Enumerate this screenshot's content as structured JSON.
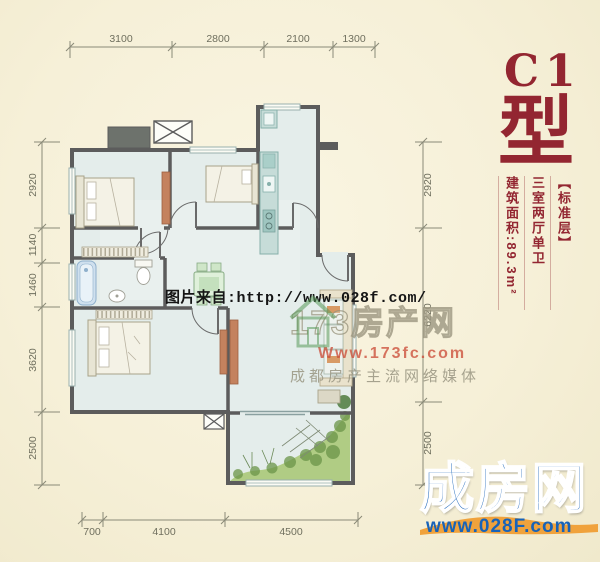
{
  "title_block": {
    "model": "C1",
    "type_suffix": "型",
    "floor_tag": "【标准层】",
    "layout_desc": "三室两厅单卫",
    "area_label": "建筑面积:89.3m²"
  },
  "watermarks": {
    "photo_source": "图片来自:http://www.028f.com/",
    "portal_name": "173房产网",
    "portal_url": "Www.173fc.com",
    "portal_slogan": "成都房产主流网络媒体"
  },
  "footer_logo": {
    "name": "成房网",
    "url": "www.028F.com"
  },
  "dims": {
    "top": [
      "3100",
      "2800",
      "2100",
      "1300"
    ],
    "left": [
      "2920",
      "1140",
      "1460",
      "3620",
      "2500"
    ],
    "right": [
      "2920",
      "6220",
      "2500"
    ],
    "bottom": [
      "700",
      "4100",
      "4500"
    ]
  },
  "colors": {
    "accent_red": "#932631",
    "logo_blue": "#1863b8",
    "logo_orange": "#f0a23c",
    "floor_fill": "#e4edeb",
    "wall_gray": "#5c5c5c"
  }
}
